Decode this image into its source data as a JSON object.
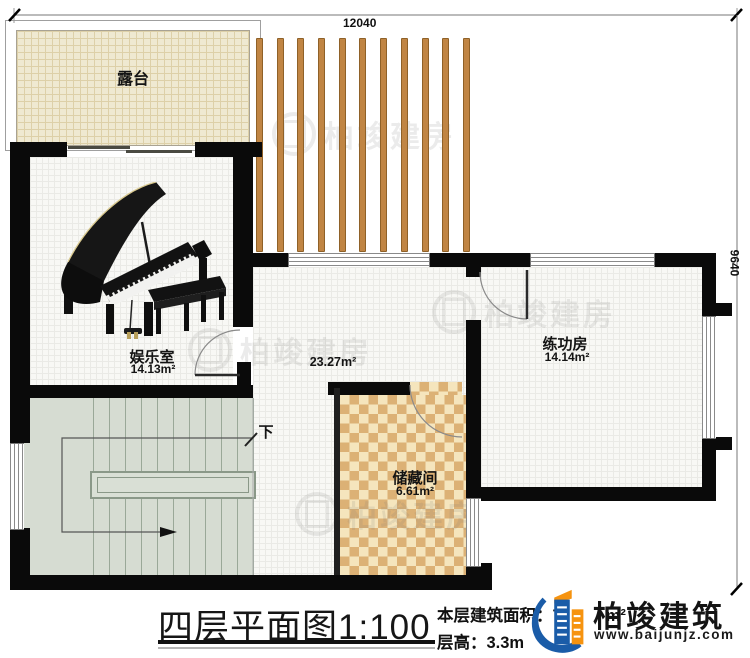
{
  "plan": {
    "dim_top": "12040",
    "dim_right": "9640",
    "terrace_label": "露台",
    "entertainment_label": "娱乐室",
    "entertainment_area": "14.13m²",
    "hall_area": "23.27m²",
    "practice_label": "练功房",
    "practice_area": "14.14m²",
    "storage_label": "储藏间",
    "storage_area": "6.61m²",
    "stairs_down_label": "下"
  },
  "title_block": {
    "title": "四层平面图",
    "scale": "1:100",
    "floor_area_label": "本层建筑面积：",
    "floor_area_prefix": "7",
    "floor_area_suffix": "m²",
    "floor_height": "层高：3.3m"
  },
  "brand": {
    "name": "柏竣建筑",
    "website": "www.baijunjz.com",
    "blue": "#1a5ca8",
    "orange": "#f6930f"
  },
  "watermark": {
    "text": "柏竣建房"
  }
}
